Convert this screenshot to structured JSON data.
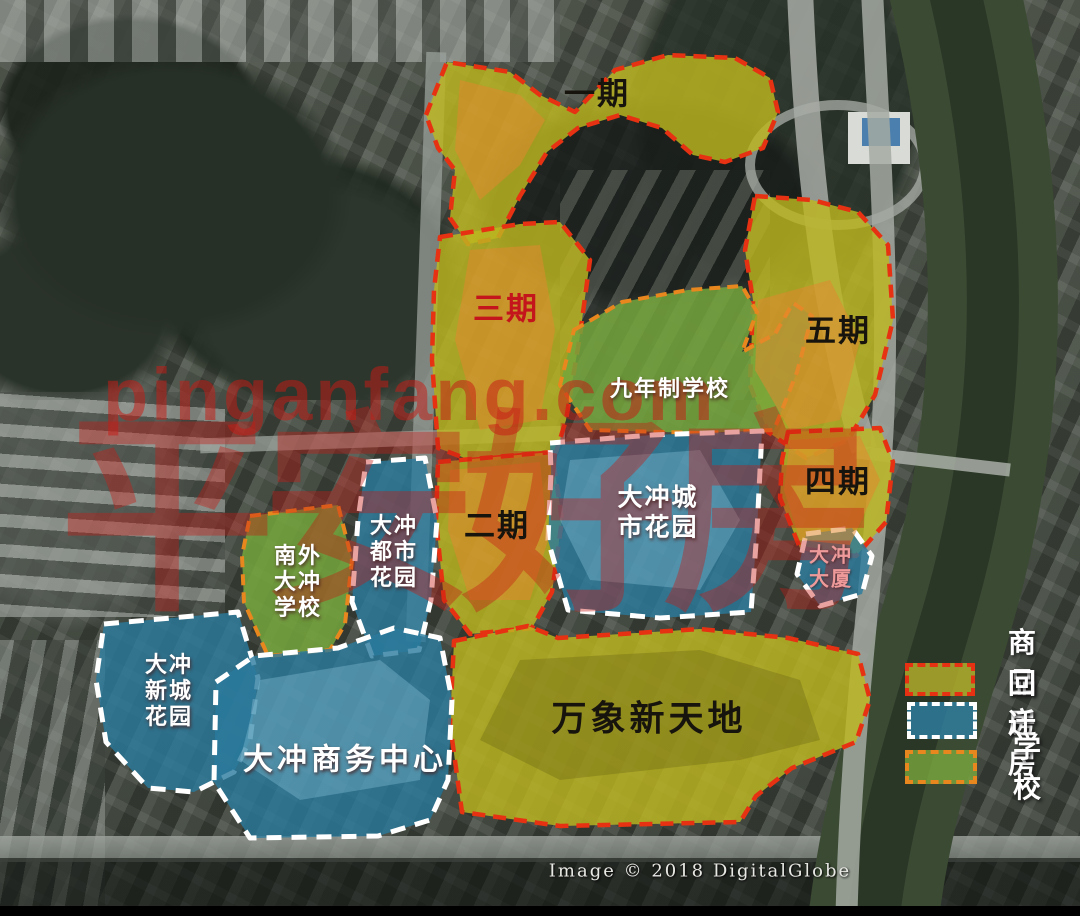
{
  "zones": {
    "phase1": {
      "label": "一期",
      "type": "commodity"
    },
    "phase2": {
      "label": "二期",
      "type": "commodity"
    },
    "phase3": {
      "label": "三期",
      "type": "commodity"
    },
    "phase4": {
      "label": "四期",
      "type": "commodity"
    },
    "phase5": {
      "label": "五期",
      "type": "commodity"
    },
    "nine_year_school": {
      "label": "九年制学校",
      "type": "school"
    },
    "nanwai_school": {
      "label": "南外\n大冲\n学校",
      "type": "school"
    },
    "city_garden": {
      "label": "大冲城\n市花园",
      "type": "relocation"
    },
    "metro_garden": {
      "label": "大冲\n都市\n花园",
      "type": "relocation"
    },
    "dachong_tower": {
      "label": "大冲\n大厦",
      "type": "relocation"
    },
    "newtown_garden": {
      "label": "大冲\n新城\n花园",
      "type": "relocation"
    },
    "business_center": {
      "label": "大冲商务中心",
      "type": "relocation"
    },
    "mixc_world": {
      "label": "万象新天地",
      "type": "commodity"
    }
  },
  "legend": {
    "items": [
      {
        "label": "商品房",
        "fill": "#b8b32a",
        "border": "#e63212",
        "key": "commodity"
      },
      {
        "label": "回迁房",
        "fill": "#2e7fa3",
        "border": "#ffffff",
        "key": "relocation"
      },
      {
        "label": "学校",
        "fill": "#79a83e",
        "border": "#e8871e",
        "key": "school"
      }
    ]
  },
  "watermark": {
    "url": "pinganfang.com",
    "brand": "平安好房",
    "color": "#c61c16"
  },
  "credit": "Image © 2018 DigitalGlobe",
  "colors": {
    "commodity_fill": "#bdb720",
    "commodity_border": "#e63212",
    "relocation_fill": "#2a7a9e",
    "relocation_border": "#ffffff",
    "school_fill": "#75a63c",
    "school_border": "#e8871e",
    "phase_label": "#17130d",
    "phase3_label": "#c3151b",
    "tower_label": "#ef9a9a"
  }
}
